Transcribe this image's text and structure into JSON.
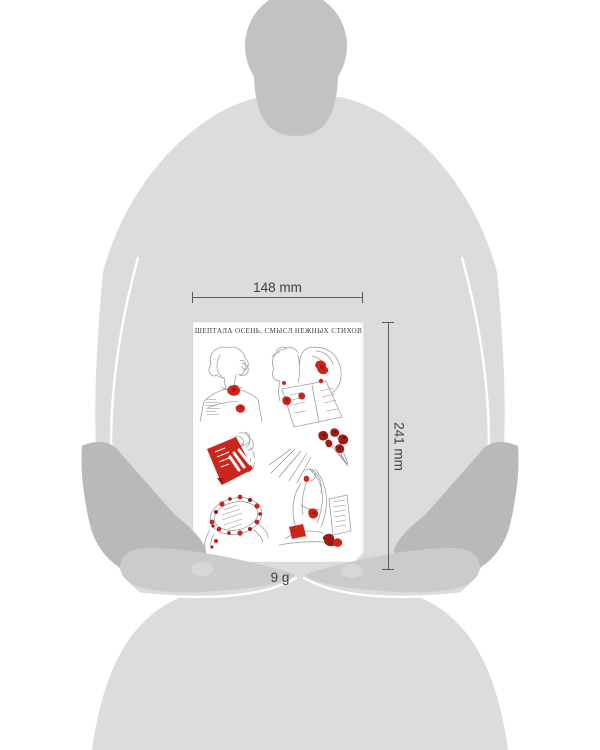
{
  "annotations": {
    "width_label": "148 mm",
    "height_label": "241 mm",
    "weight_label": "9 g"
  },
  "sheet": {
    "title": "ШЕПТАЛА ОСЕНЬ, СМЫСЛ НЕЖНЫХ СТИХОВ",
    "stickers": [
      "woman-bust-with-red-rose",
      "couple-reading-letter",
      "hand-holding-red-book",
      "red-poppy-bouquet",
      "flower-wreath-around-verses",
      "woman-reading-in-sun-rays"
    ]
  },
  "colors": {
    "body_gray": "#dcdcdc",
    "head_gray": "#c2c2c2",
    "sleeve_gray": "#b9b9b9",
    "hand_gray": "#cbcbcb",
    "knuckle_gray": "#d7d7d7",
    "sheet_white": "#ffffff",
    "accent_red": "#cf241b",
    "accent_dark_red": "#9e1a12",
    "lineart_gray": "#9aa0a6",
    "annotation_dark": "#3f3f3f",
    "dim_line": "#5a5a5a"
  }
}
